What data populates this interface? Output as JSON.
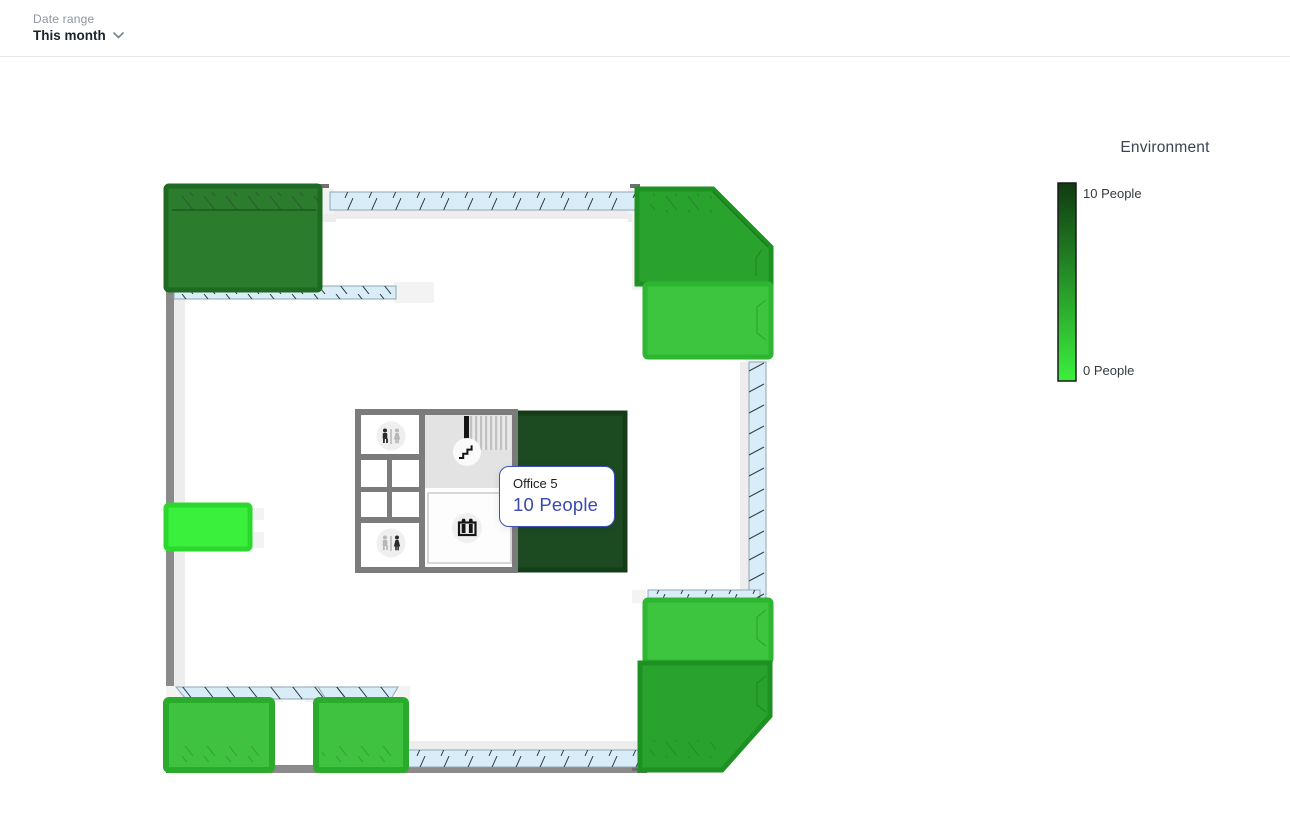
{
  "header": {
    "date_range_label": "Date range",
    "date_range_value": "This month"
  },
  "legend": {
    "title": "Environment",
    "max_label": "10 People",
    "min_label": "0 People",
    "color_max": "#113a12",
    "color_min": "#3bef3d"
  },
  "tooltip": {
    "room_name": "Office 5",
    "occupancy": "10 People",
    "border_color": "#3f51b5",
    "value_color": "#3a49b0"
  },
  "floorplan": {
    "colors": {
      "wall": "#8a8a8a",
      "core_wall": "#7b7b7b",
      "glass": "#d9edf9",
      "glass_frame": "#8fa6b2",
      "white_wall": "#f3f3f3",
      "shadow": "#ededee",
      "stairs_floor": "#e3e3e3"
    },
    "rooms": [
      {
        "id": "room-top-left",
        "fill": "#2b7c2c",
        "stroke": "#1f6a21"
      },
      {
        "id": "room-top-right-upper",
        "fill": "#2aa32e",
        "stroke": "#1d9222"
      },
      {
        "id": "room-top-right-lower",
        "fill": "#3dc53f",
        "stroke": "#2eb531"
      },
      {
        "id": "office-5",
        "fill": "#1c4a21",
        "stroke": "#143c18"
      },
      {
        "id": "room-left-middle",
        "fill": "#3bef3d",
        "stroke": "#2bd92e"
      },
      {
        "id": "room-bottom-left-1",
        "fill": "#3ec23f",
        "stroke": "#2bab2c"
      },
      {
        "id": "room-bottom-left-2",
        "fill": "#3ec23f",
        "stroke": "#2bab2c"
      },
      {
        "id": "room-bottom-right-upper",
        "fill": "#3dc53f",
        "stroke": "#2eb531"
      },
      {
        "id": "room-bottom-right-lower",
        "fill": "#2aa32e",
        "stroke": "#1d9222"
      }
    ],
    "icons": {
      "restroom_men": "restroom-men-icon",
      "restroom_women": "restroom-women-icon",
      "stairs": "stairs-icon",
      "elevator": "elevator-icon"
    }
  }
}
